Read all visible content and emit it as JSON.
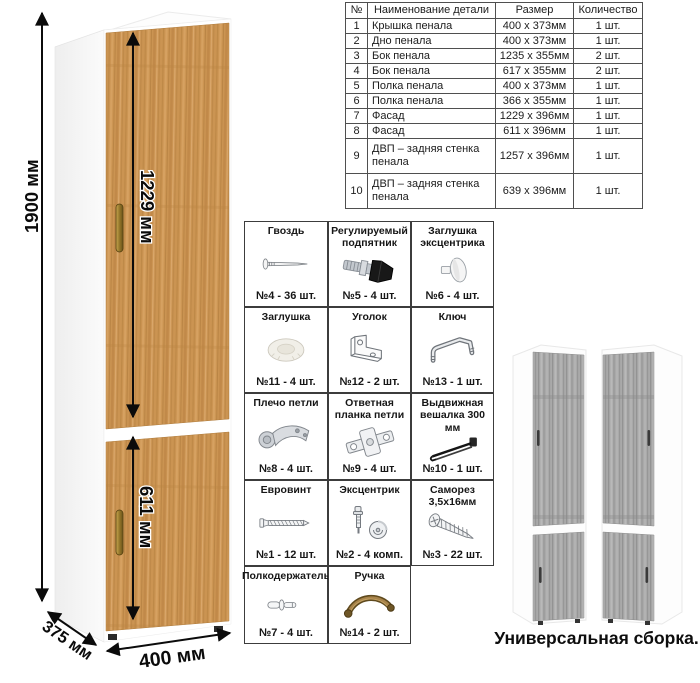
{
  "cabinet": {
    "dim_height": "1900 мм",
    "dim_upper_door": "1229 мм",
    "dim_lower_door": "611 мм",
    "dim_depth": "375 мм",
    "dim_width": "400 мм",
    "wood_color": "#cb9452",
    "handle_color": "#8f7227"
  },
  "parts_table": {
    "headers": [
      "№",
      "Наименование детали",
      "Размер",
      "Количество"
    ],
    "rows": [
      {
        "num": "1",
        "name": "Крышка пенала",
        "size": "400 х 373мм",
        "qty": "1 шт."
      },
      {
        "num": "2",
        "name": "Дно пенала",
        "size": "400 х 373мм",
        "qty": "1 шт."
      },
      {
        "num": "3",
        "name": "Бок пенала",
        "size": "1235 х 355мм",
        "qty": "2 шт."
      },
      {
        "num": "4",
        "name": "Бок пенала",
        "size": "617 х 355мм",
        "qty": "2 шт."
      },
      {
        "num": "5",
        "name": "Полка пенала",
        "size": "400 х 373мм",
        "qty": "1 шт."
      },
      {
        "num": "6",
        "name": "Полка пенала",
        "size": "366 х 355мм",
        "qty": "1 шт."
      },
      {
        "num": "7",
        "name": "Фасад",
        "size": "1229 х 396мм",
        "qty": "1 шт."
      },
      {
        "num": "8",
        "name": "Фасад",
        "size": "611 х 396мм",
        "qty": "1 шт."
      },
      {
        "num": "9",
        "name": "ДВП – задняя стенка пенала",
        "size": "1257 х 396мм",
        "qty": "1 шт."
      },
      {
        "num": "10",
        "name": "ДВП – задняя стенка пенала",
        "size": "639 х 396мм",
        "qty": "1 шт."
      }
    ]
  },
  "hardware": {
    "items": [
      {
        "title": "Гвоздь",
        "qty": "№4 - 36 шт.",
        "icon": "nail-icon"
      },
      {
        "title": "Регулируемый подпятник",
        "qty": "№5 - 4 шт.",
        "icon": "adjustable-foot-icon"
      },
      {
        "title": "Заглушка эксцентрика",
        "qty": "№6 - 4 шт.",
        "icon": "cam-cover-icon"
      },
      {
        "title": "Заглушка",
        "qty": "№11 - 4 шт.",
        "icon": "cap-icon"
      },
      {
        "title": "Уголок",
        "qty": "№12 - 2 шт.",
        "icon": "angle-bracket-icon"
      },
      {
        "title": "Ключ",
        "qty": "№13 - 1 шт.",
        "icon": "hex-key-icon"
      },
      {
        "title": "Плечо петли",
        "qty": "№8 - 4 шт.",
        "icon": "hinge-arm-icon"
      },
      {
        "title": "Ответная планка петли",
        "qty": "№9 - 4 шт.",
        "icon": "hinge-plate-icon"
      },
      {
        "title": "Выдвижная вешалка 300 мм",
        "qty": "№10 - 1 шт.",
        "icon": "pullout-hanger-icon"
      },
      {
        "title": "Евровинт",
        "qty": "№1 - 12 шт.",
        "icon": "euro-screw-icon"
      },
      {
        "title": "Эксцентрик",
        "qty": "№2 - 4 комп.",
        "icon": "cam-lock-icon"
      },
      {
        "title": "Саморез 3,5х16мм",
        "qty": "№3 - 22 шт.",
        "icon": "self-tapping-screw-icon"
      },
      {
        "title": "Полкодержатель",
        "qty": "№7 - 4 шт.",
        "icon": "shelf-pin-icon"
      },
      {
        "title": "Ручка",
        "qty": "№14 - 2 шт.",
        "icon": "pull-handle-icon"
      }
    ]
  },
  "variants": {
    "caption": "Универсальная сборка.",
    "gray_wood_color": "#a9a9a9"
  }
}
